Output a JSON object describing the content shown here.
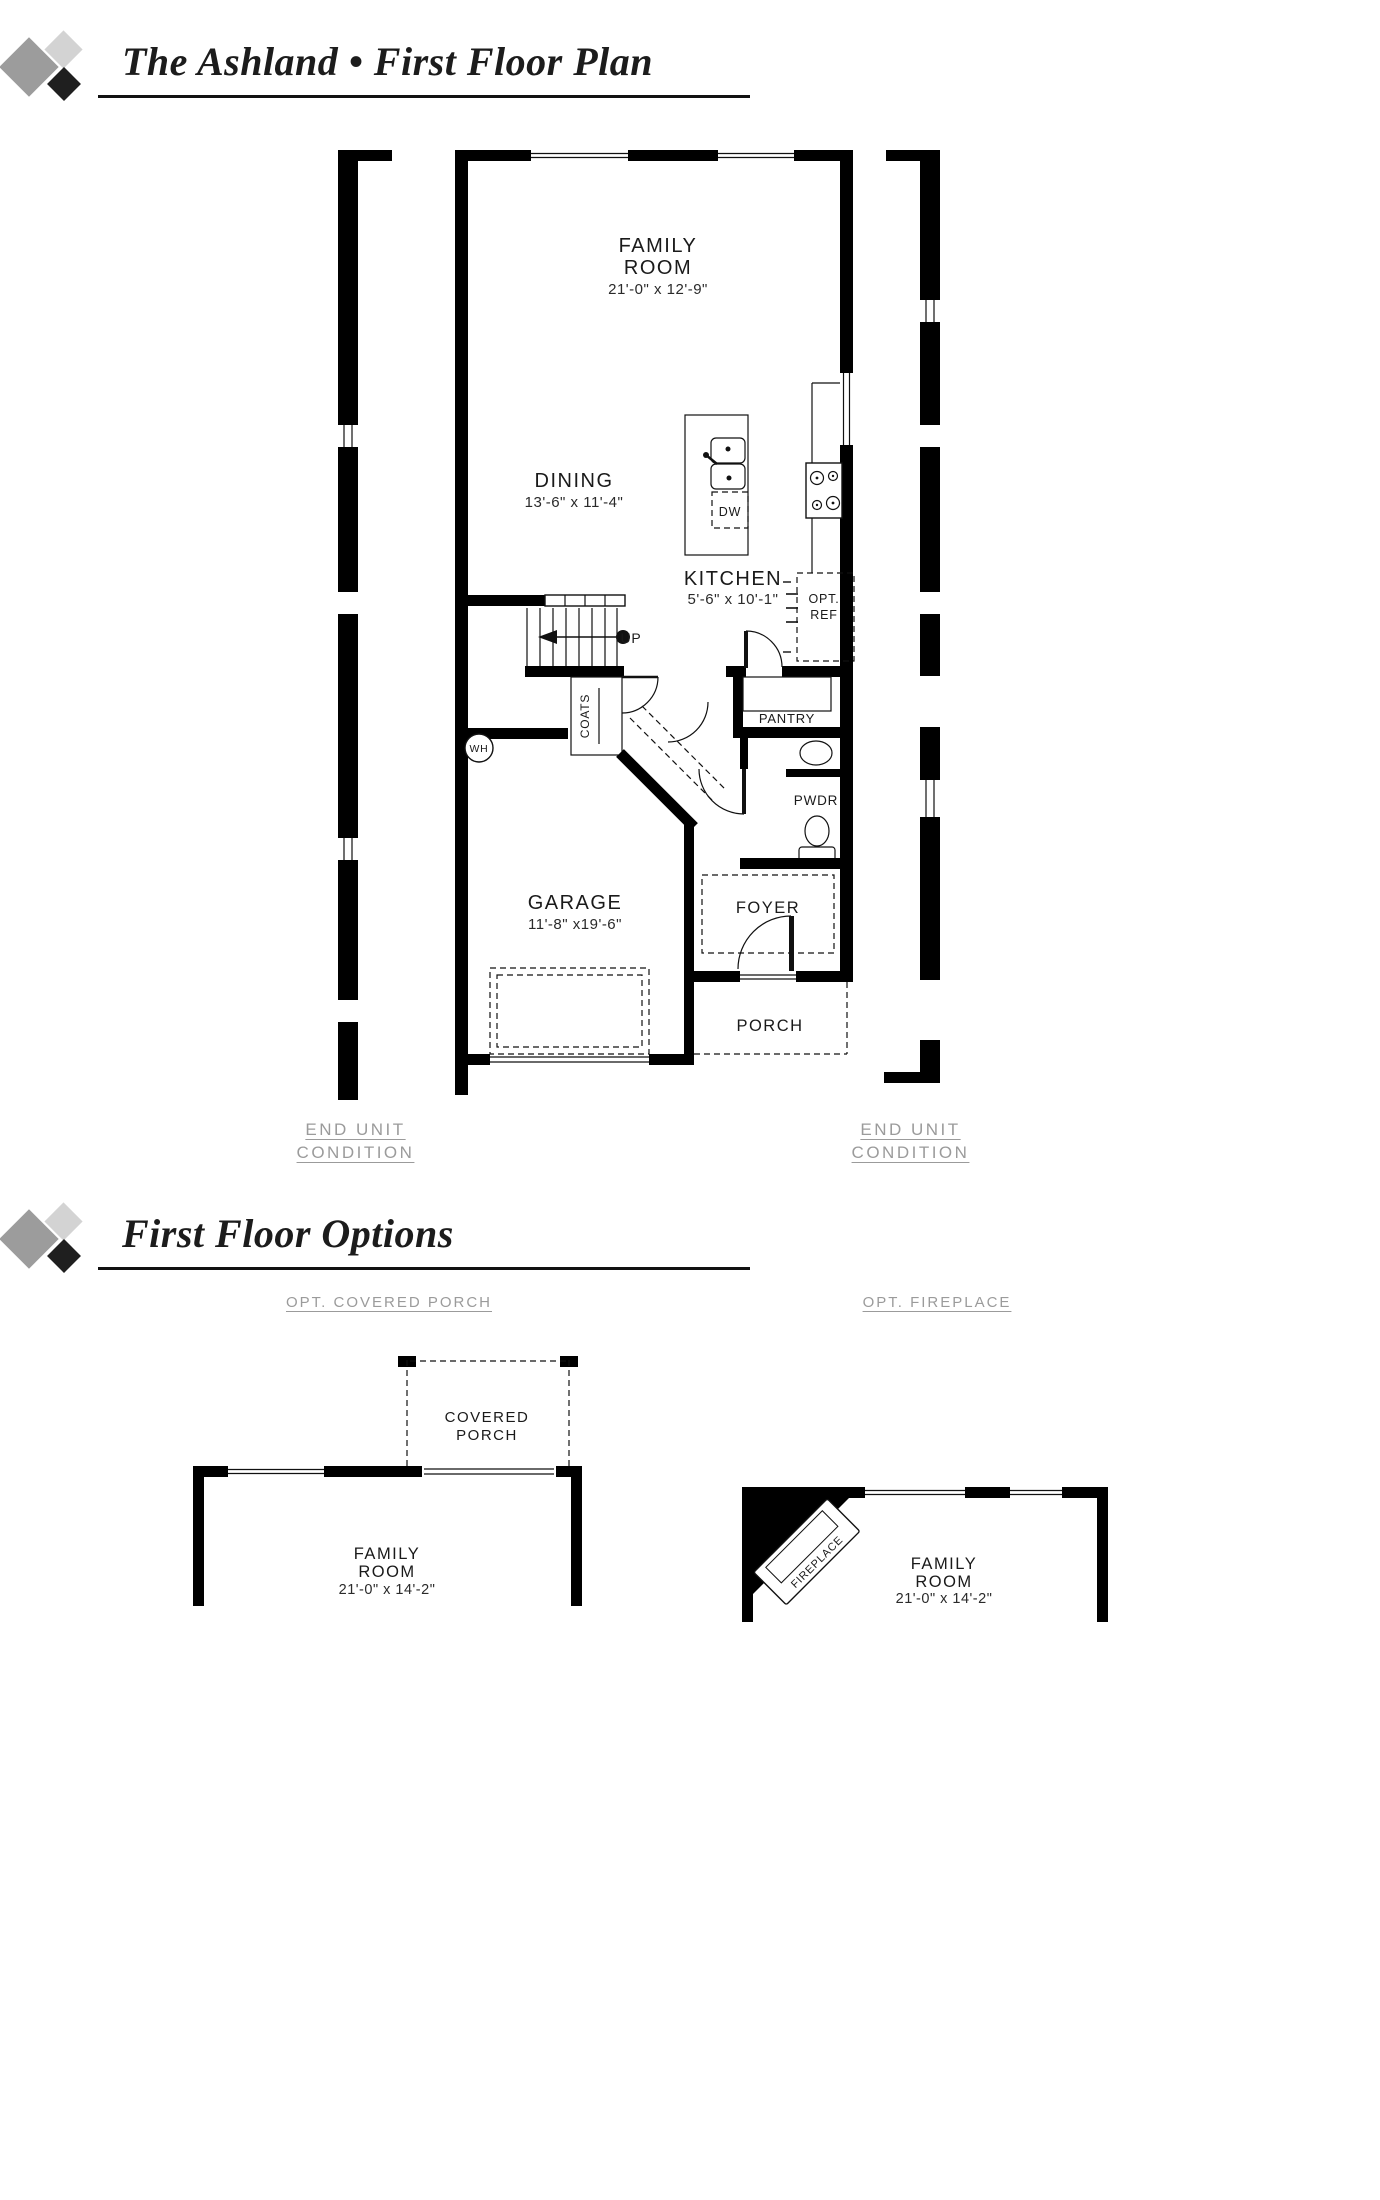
{
  "titles": {
    "main": "The Ashland • First Floor Plan",
    "options": "First Floor Options"
  },
  "plan": {
    "family_room": {
      "line1": "FAMILY",
      "line2": "ROOM",
      "dims": "21'-0\" x 12'-9\""
    },
    "dining": {
      "line1": "DINING",
      "dims": "13'-6\" x 11'-4\""
    },
    "kitchen": {
      "line1": "KITCHEN",
      "dims": "5'-6\" x 10'-1\""
    },
    "garage": {
      "line1": "GARAGE",
      "dims": "11'-8\" x19'-6\""
    },
    "foyer": "FOYER",
    "porch": "PORCH",
    "pantry": "PANTRY",
    "powder": "PWDR",
    "coats": "COATS",
    "up": "UP",
    "wh": "WH",
    "dw": "DW",
    "opt_ref_line1": "OPT.",
    "opt_ref_line2": "REF"
  },
  "annotations": {
    "end_unit_left": {
      "line1": "END UNIT",
      "line2": "CONDITION"
    },
    "end_unit_right": {
      "line1": "END UNIT",
      "line2": "CONDITION"
    }
  },
  "options": {
    "covered_porch": {
      "caption": "OPT. COVERED PORCH",
      "room1": "COVERED",
      "room2": "PORCH",
      "family1": "FAMILY",
      "family2": "ROOM",
      "dims": "21'-0\" x 14'-2\""
    },
    "fireplace": {
      "caption": "OPT. FIREPLACE",
      "label": "FIREPLACE",
      "family1": "FAMILY",
      "family2": "ROOM",
      "dims": "21'-0\" x 14'-2\""
    }
  },
  "colors": {
    "wall": "#000000",
    "plan_text": "#1a1a1a",
    "muted_text": "#9b9b9b",
    "logo_gray": "#9c9c9c",
    "logo_light": "#d3d3d3",
    "logo_black": "#1f1f1f"
  }
}
